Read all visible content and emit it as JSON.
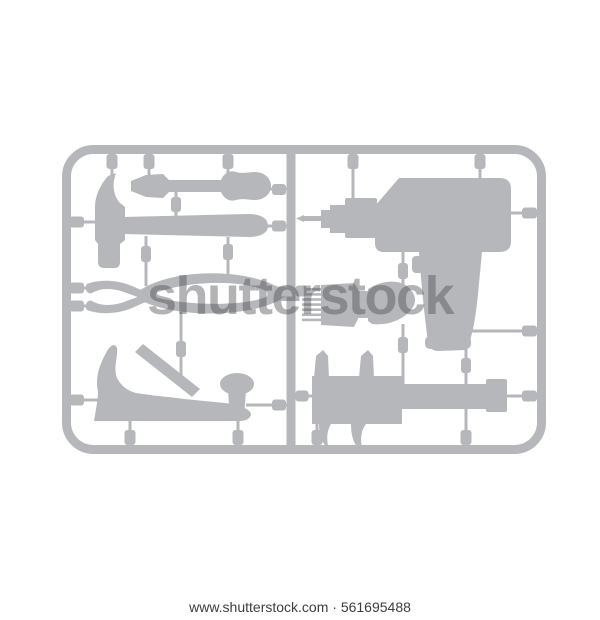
{
  "image": {
    "watermark": {
      "text": "shutterstock"
    },
    "caption": {
      "text": "www.shutterstock.com · 561695488"
    }
  },
  "colors": {
    "background": "#ffffff",
    "silhouette": "#b6b7ba",
    "watermark": "#4b4b50",
    "caption": "#3d3d3d"
  },
  "sprue": {
    "tools": [
      "claw-hammer",
      "flat-screwdriver",
      "combination-pliers",
      "hand-plane",
      "power-drill",
      "paint-brush",
      "vernier-caliper"
    ]
  }
}
